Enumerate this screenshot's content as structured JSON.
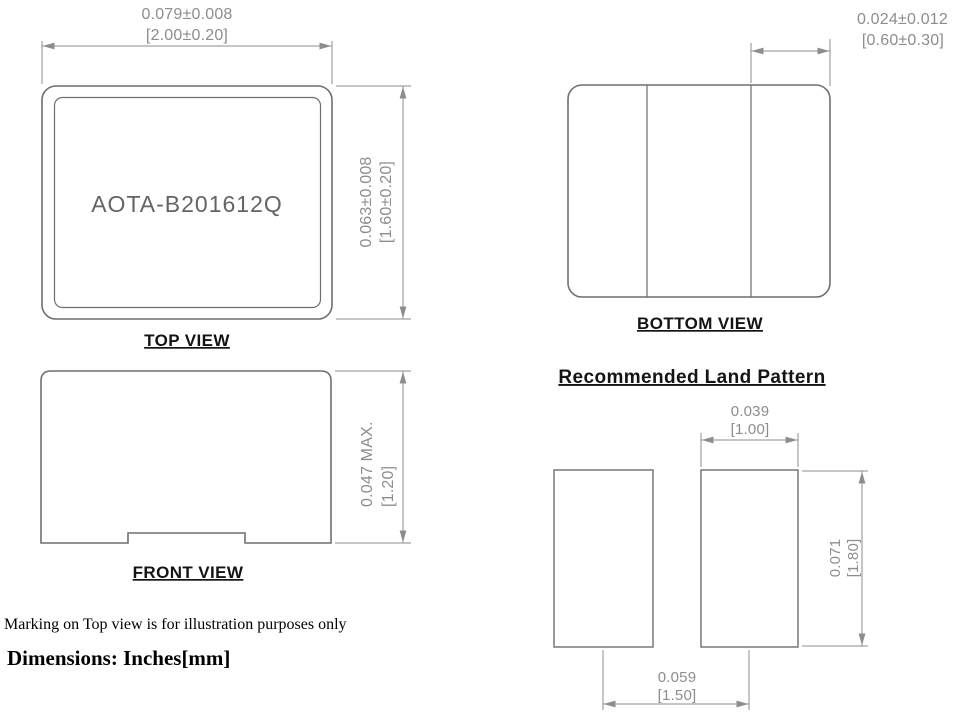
{
  "drawing": {
    "views": {
      "top": {
        "label": "TOP VIEW",
        "marking": "AOTA-B201612Q",
        "width_dim": {
          "inch": "0.079±0.008",
          "mm": "[2.00±0.20]"
        },
        "height_dim": {
          "inch": "0.063±0.008",
          "mm": "[1.60±0.20]"
        }
      },
      "bottom": {
        "label": "BOTTOM VIEW",
        "terminal_width_dim": {
          "inch": "0.024±0.012",
          "mm": "[0.60±0.30]"
        }
      },
      "front": {
        "label": "FRONT VIEW",
        "height_dim": {
          "inch": "0.047 MAX.",
          "mm": "[1.20]"
        }
      },
      "land_pattern": {
        "title": "Recommended Land Pattern",
        "pad_width_dim": {
          "inch": "0.039",
          "mm": "[1.00]"
        },
        "pad_height_dim": {
          "inch": "0.071",
          "mm": "[1.80]"
        },
        "pad_pitch_dim": {
          "inch": "0.059",
          "mm": "[1.50]"
        }
      }
    },
    "notes": {
      "marking_note": "Marking on Top view is for illustration purposes only",
      "units_note": "Dimensions: Inches[mm]"
    },
    "colors": {
      "outline": "#6f6f6f",
      "dimension": "#8d8d8d",
      "label_text": "#141414",
      "marking_text": "#646464"
    }
  }
}
